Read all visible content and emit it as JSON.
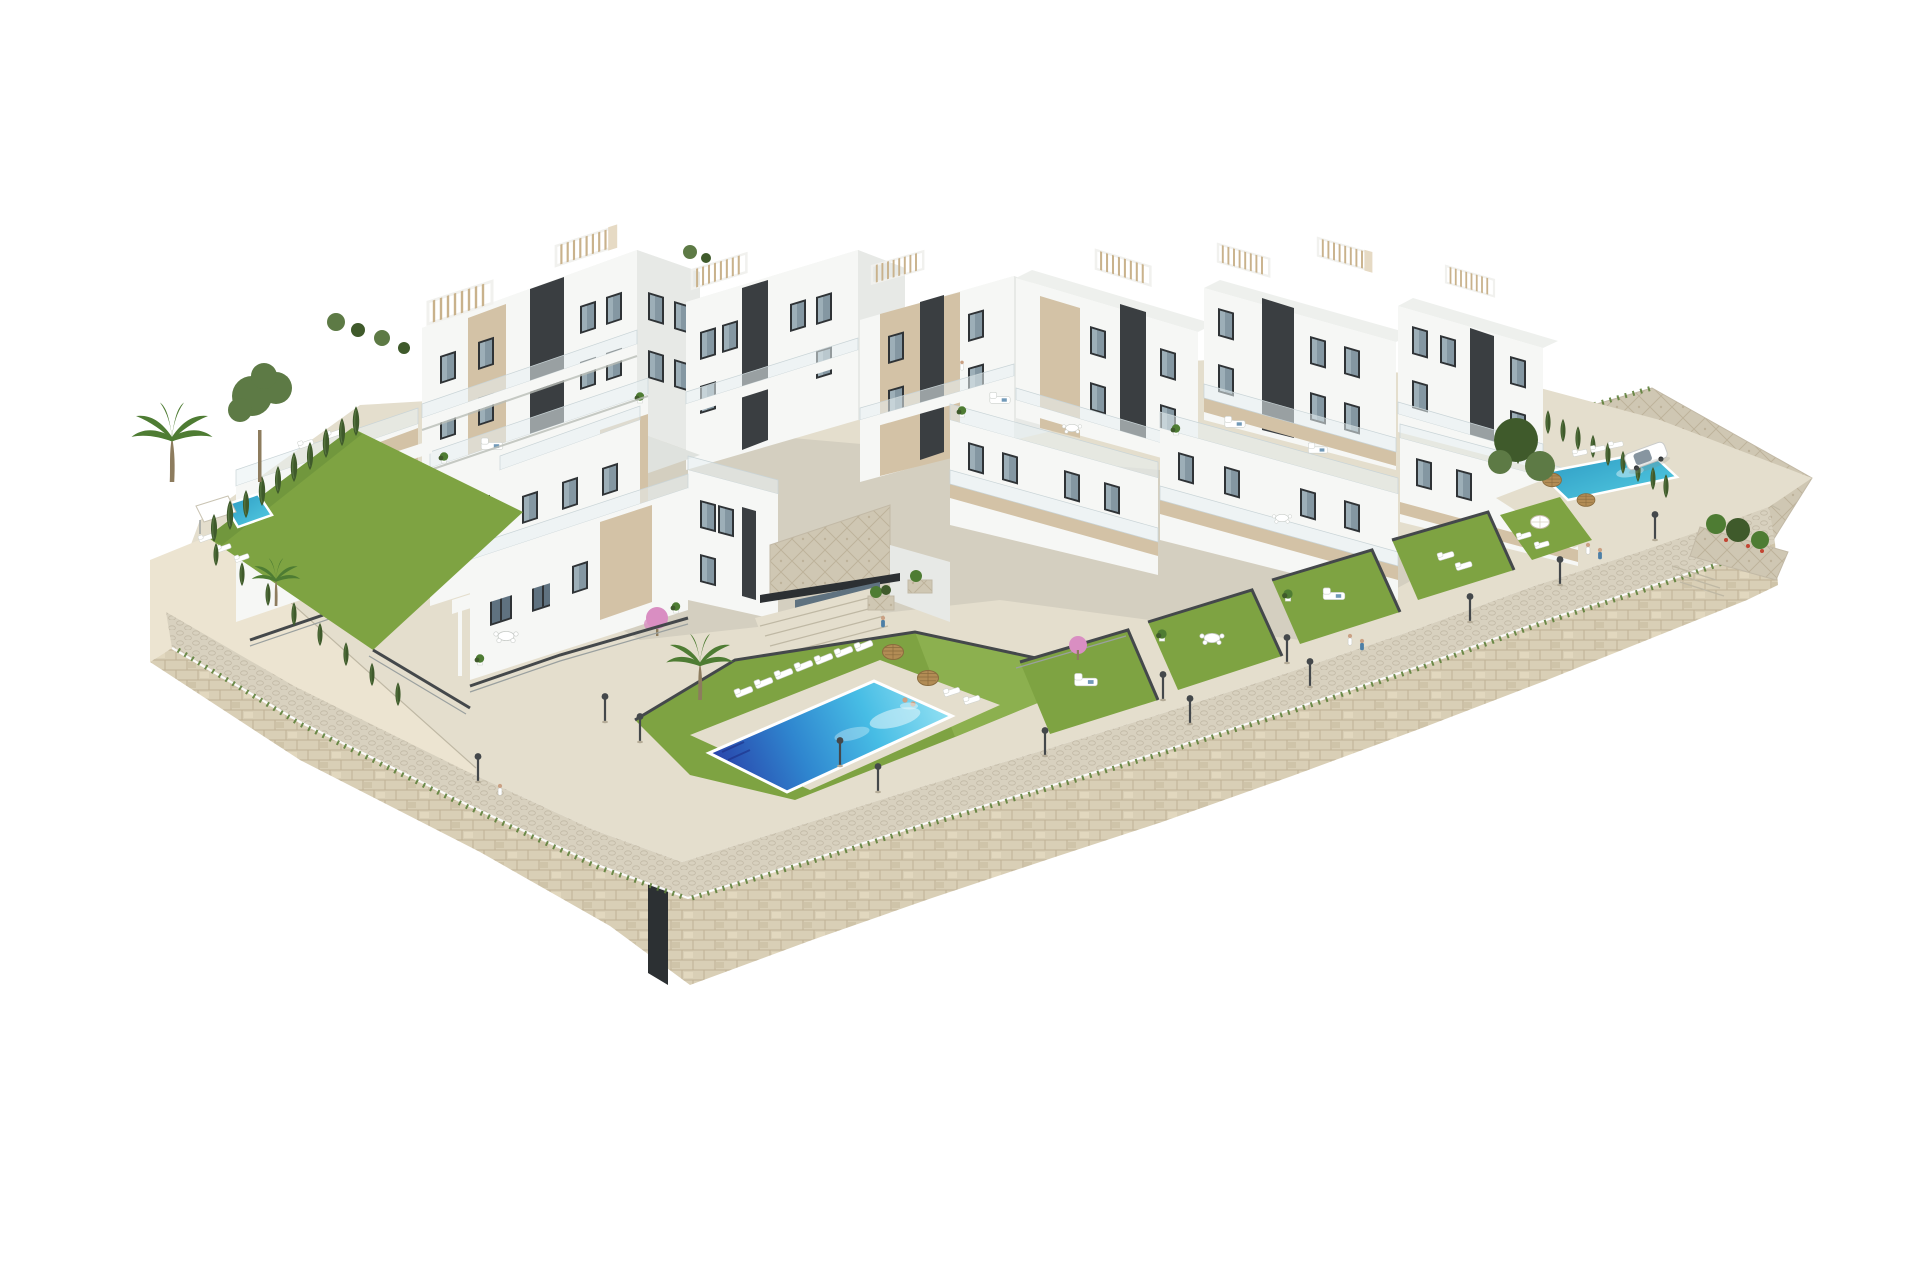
{
  "scene": {
    "type": "architectural-3d-render",
    "subject": "Hillside residential complex of white terraced apartment buildings with pools and gardens on limestone retaining walls, isolated on a white background",
    "view": "aerial axonometric from the south",
    "inventory": {
      "apartment_blocks": 11,
      "villas": 2,
      "swimming_pools": 3,
      "rooftop_pergolas": 7,
      "dark_stair_cores": 6,
      "private_garden_terraces": 4,
      "lawns": 3,
      "palm_trees": 3,
      "pine_trees": 1,
      "cypress_trees": 24,
      "sun_loungers": 22,
      "straw_umbrellas": 4,
      "white_parasols": 2,
      "street_lamps": 13,
      "people": 9,
      "cars": 1,
      "stone_retaining_walls": 2,
      "stone_paved_promenade": 1,
      "clubhouse_entrance": 1
    }
  },
  "palette": {
    "bg": "#ffffff",
    "bWhite": "#f6f7f5",
    "bShade": "#e7e9e6",
    "bDark": "#d6dad6",
    "roofL": "#eef0ed",
    "roofD": "#dfe2de",
    "beige": "#d3c2a6",
    "beigeL": "#e6dac4",
    "beigeD": "#bcab8f",
    "core": "#3a3e41",
    "coreD": "#2c3033",
    "winF": "#2f3336",
    "glass": "#8497a2",
    "glassD": "#5f7280",
    "rail": "#e8f0f2",
    "railPost": "#c9d4d7",
    "pergSlat": "#c9b28c",
    "pergFrame": "#f1f1ee",
    "lawn": "#7ea342",
    "lawnL": "#93b556",
    "lawnD": "#69903a",
    "tuft": "#5d7f3a",
    "cypress": "#3f5a2b",
    "cypressL": "#567540",
    "palmG": "#4e7c33",
    "trunk": "#8d7c5e",
    "pine": "#5d7a45",
    "wallL": "#ece4d1",
    "wallM": "#d9cfb6",
    "wallJoint": "#c0b295",
    "pave": "#d8d1bf",
    "paveL": "#e4decd",
    "paveD": "#c2b9a6",
    "mosaic": "#cfc7b3",
    "poolDeep": "#2944ab",
    "poolMid": "#2f86cf",
    "poolCyan": "#47bde5",
    "poolPale": "#8fdff2",
    "teal": "#3bbcd6",
    "tealD": "#2b98c2",
    "straw": "#b28c55",
    "strawD": "#8a6c3e",
    "metal": "#44484b",
    "pink": "#d98ec2",
    "red": "#c24532",
    "skin": "#caa184",
    "blueAcc": "#4d7fa6"
  }
}
